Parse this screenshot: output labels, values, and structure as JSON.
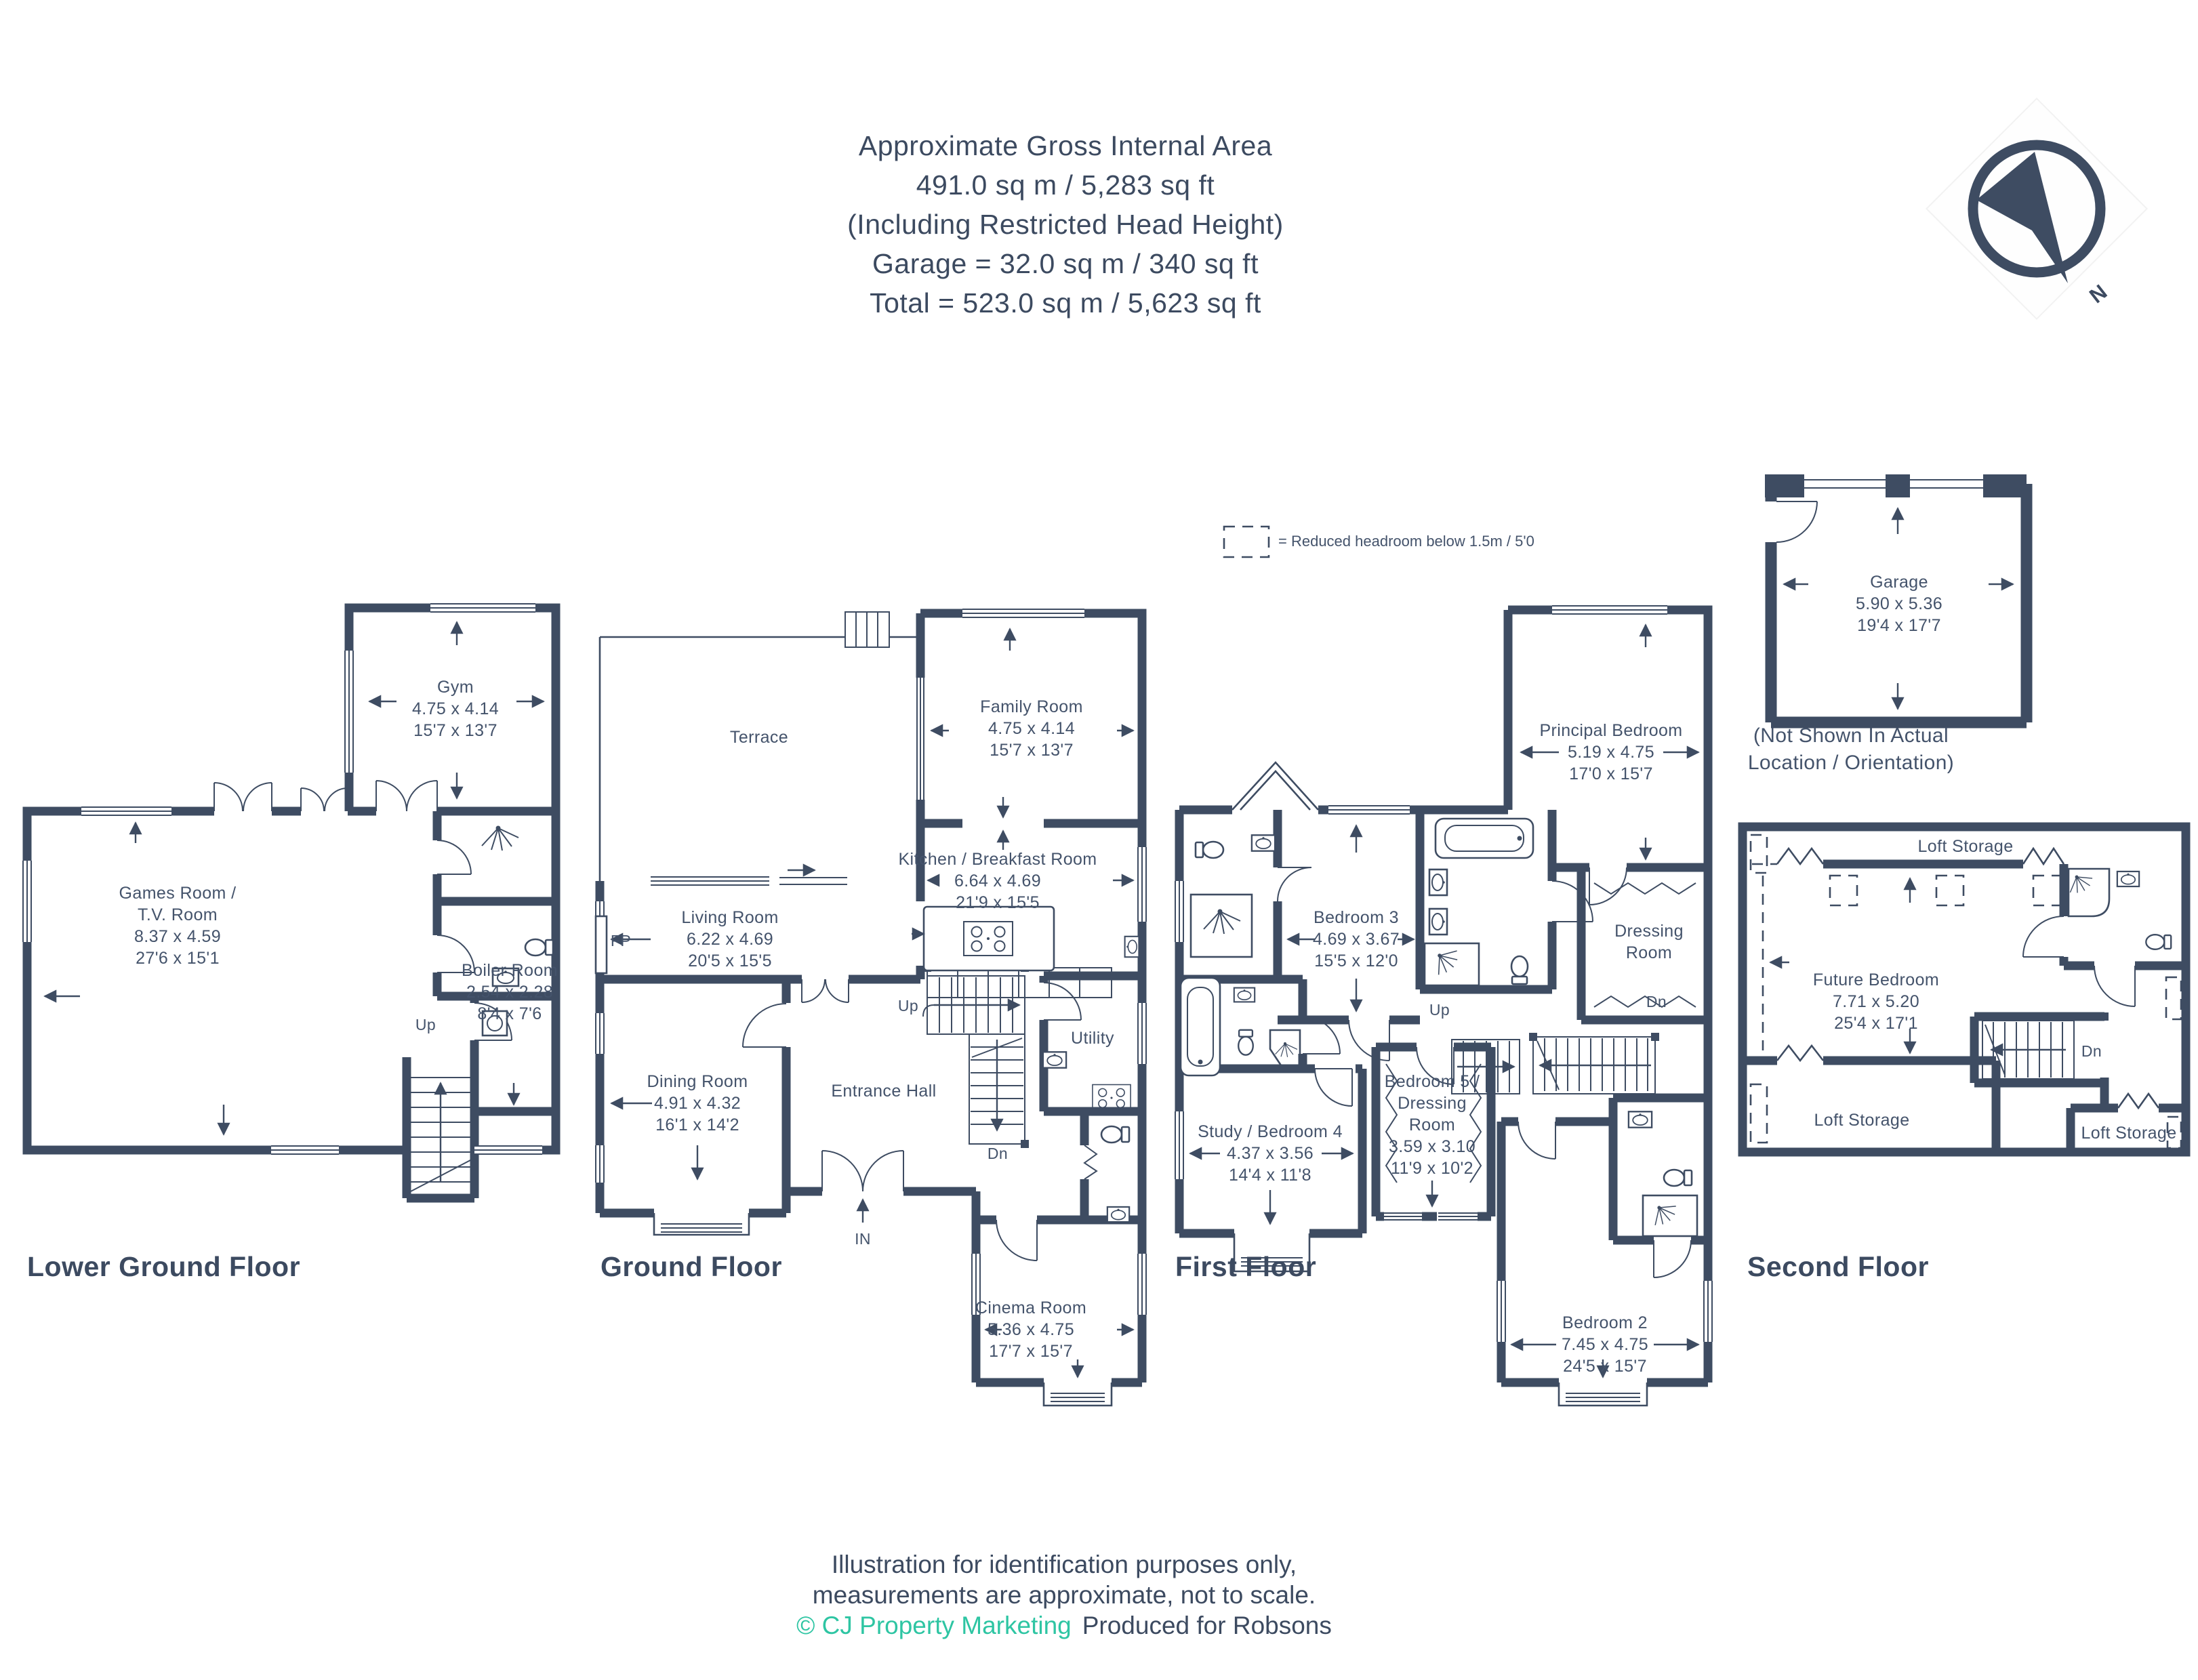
{
  "header": {
    "lines": [
      "Approximate Gross Internal Area",
      "491.0 sq m / 5,283 sq ft",
      "(Including Restricted Head Height)",
      "Garage = 32.0 sq m / 340 sq ft",
      "Total = 523.0 sq m / 5,623 sq ft"
    ]
  },
  "compass": {
    "north": "N"
  },
  "legend": {
    "text": "= Reduced headroom below 1.5m / 5'0"
  },
  "colors": {
    "wall": "#3E4C62",
    "label_text": "#44536B",
    "teal": "#2EC5A3"
  },
  "floors": {
    "lower_ground": {
      "title": "Lower Ground Floor",
      "rooms": {
        "gym": {
          "name": "Gym",
          "metric": "4.75 x 4.14",
          "imperial": "15'7 x 13'7"
        },
        "games": {
          "name": "Games Room /",
          "name2": "T.V. Room",
          "metric": "8.37 x 4.59",
          "imperial": "27'6 x 15'1"
        },
        "boiler": {
          "name": "Boiler Room",
          "metric": "2.54 x 2.28",
          "imperial": "8'4 x 7'6"
        }
      },
      "stairs": {
        "up": "Up"
      }
    },
    "ground": {
      "title": "Ground Floor",
      "rooms": {
        "terrace": {
          "name": "Terrace"
        },
        "family": {
          "name": "Family Room",
          "metric": "4.75 x 4.14",
          "imperial": "15'7 x 13'7"
        },
        "living": {
          "name": "Living Room",
          "metric": "6.22 x 4.69",
          "imperial": "20'5 x 15'5",
          "fp": "FP"
        },
        "kitchen": {
          "name": "Kitchen / Breakfast Room",
          "metric": "6.64 x 4.69",
          "imperial": "21'9 x 15'5"
        },
        "dining": {
          "name": "Dining Room",
          "metric": "4.91 x 4.32",
          "imperial": "16'1 x 14'2"
        },
        "entrance": {
          "name": "Entrance Hall"
        },
        "utility": {
          "name": "Utility"
        },
        "cinema": {
          "name": "Cinema Room",
          "metric": "5.36 x 4.75",
          "imperial": "17'7 x 15'7"
        }
      },
      "stairs": {
        "up": "Up",
        "dn": "Dn"
      },
      "entry": {
        "in": "IN"
      }
    },
    "first": {
      "title": "First Floor",
      "rooms": {
        "principal": {
          "name": "Principal Bedroom",
          "metric": "5.19 x 4.75",
          "imperial": "17'0 x 15'7"
        },
        "bedroom3": {
          "name": "Bedroom 3",
          "metric": "4.69 x 3.67",
          "imperial": "15'5 x 12'0"
        },
        "dressing": {
          "name": "Dressing",
          "name2": "Room"
        },
        "study": {
          "name": "Study / Bedroom 4",
          "metric": "4.37 x 3.56",
          "imperial": "14'4 x 11'8"
        },
        "bedroom5": {
          "name": "Bedroom 5 /",
          "name2": "Dressing",
          "name3": "Room",
          "metric": "3.59 x 3.10",
          "imperial": "11'9 x 10'2"
        },
        "bedroom2": {
          "name": "Bedroom 2",
          "metric": "7.45 x 4.75",
          "imperial": "24'5 x 15'7"
        }
      },
      "stairs": {
        "up": "Up",
        "dn": "Dn"
      }
    },
    "second": {
      "title": "Second Floor",
      "rooms": {
        "loft_top": {
          "name": "Loft Storage"
        },
        "future": {
          "name": "Future Bedroom",
          "metric": "7.71 x 5.20",
          "imperial": "25'4 x 17'1"
        },
        "loft_bottom_left": {
          "name": "Loft Storage"
        },
        "loft_bottom_right": {
          "name": "Loft Storage"
        }
      },
      "stairs": {
        "dn": "Dn"
      }
    },
    "garage": {
      "name": "Garage",
      "metric": "5.90 x 5.36",
      "imperial": "19'4 x 17'7",
      "caption1": "(Not Shown In Actual",
      "caption2": "Location / Orientation)"
    }
  },
  "footer": {
    "line1": "Illustration for identification purposes only,",
    "line2": "measurements are approximate, not to scale.",
    "credit": "© CJ Property Marketing",
    "produced": "Produced for Robsons"
  }
}
